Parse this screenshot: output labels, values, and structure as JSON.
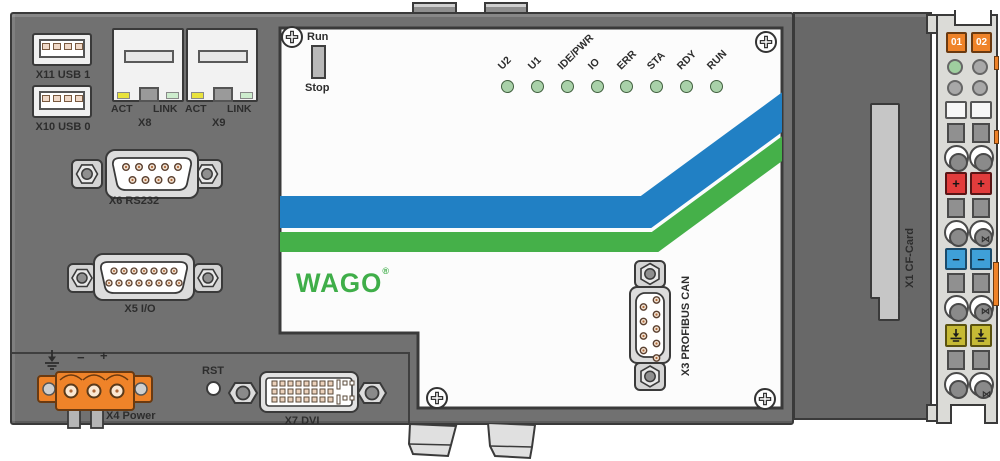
{
  "ports": {
    "usb1_label": "X11 USB 1",
    "usb0_label": "X10 USB 0",
    "eth1": {
      "act": "ACT",
      "link": "LINK",
      "name": "X8"
    },
    "eth2": {
      "act": "ACT",
      "link": "LINK",
      "name": "X9"
    },
    "rs232_label": "X6 RS232",
    "io_label": "X5 I/O",
    "power_label": "X4 Power",
    "power_minus": "−",
    "power_plus": "+",
    "reset_label": "RST",
    "dvi_label": "X7 DVI",
    "profibus_label": "X3 PROFIBUS CAN",
    "cfcard_label": "X1 CF-Card"
  },
  "panel": {
    "run_label": "Run",
    "stop_label": "Stop",
    "leds": [
      "U2",
      "U1",
      "IDE/PWR",
      "IO",
      "ERR",
      "STA",
      "RDY",
      "RUN"
    ],
    "logo_text": "WAGO",
    "logo_reg": "®"
  },
  "terminal_module": {
    "tab_01": "01",
    "tab_02": "02",
    "plus": "+",
    "minus": "−"
  },
  "icons": {
    "bowtie_glyph": "⋈"
  },
  "colors": {
    "case_gray": "#717171",
    "case_right_gray": "#686868",
    "panel_white": "#fcfcfc",
    "stripe_blue": "#2180c4",
    "stripe_green": "#45b049",
    "logo_green": "#3fae49",
    "connector_orange": "#ef8329",
    "terminal_red": "#e23c3c",
    "terminal_blue": "#3fa0d8",
    "terminal_yellow": "#c6ba35",
    "act_led_yellow": "#e8e23c",
    "link_led_green": "#cdeccd",
    "status_led_green": "#a9d1a9"
  }
}
